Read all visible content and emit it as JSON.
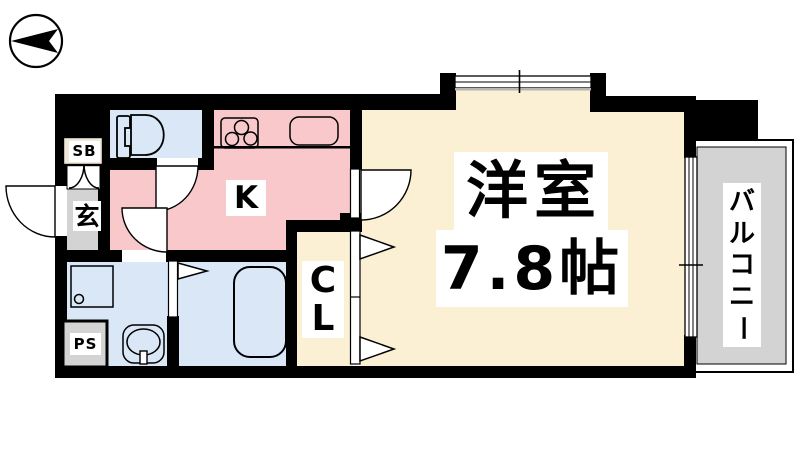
{
  "colors": {
    "wall": "#000000",
    "kitchen_pink": "#f8c8ca",
    "water_blue": "#d9e7f7",
    "room_cream": "#fbf0d3",
    "floor_gray": "#d3d3d3",
    "shoebox_beige": "#f1e8da",
    "window_gray": "#b5b5b5"
  },
  "floor_plan": {
    "compass": "north-arrow-pointing-left",
    "rooms": {
      "entrance": {
        "label": "玄"
      },
      "shoe_box": {
        "label": "SB"
      },
      "kitchen": {
        "label": "K"
      },
      "closet": {
        "label_chars": [
          "C",
          "L"
        ]
      },
      "main_room": {
        "name": "洋室",
        "size": "7.8帖"
      },
      "balcony": {
        "label_chars": [
          "バ",
          "ル",
          "コ",
          "ニ",
          "ー"
        ]
      },
      "pipe_space": {
        "label": "PS"
      }
    },
    "fixtures": [
      "toilet",
      "stove",
      "sink",
      "washing-machine-pan",
      "washbasin",
      "bathtub"
    ]
  }
}
